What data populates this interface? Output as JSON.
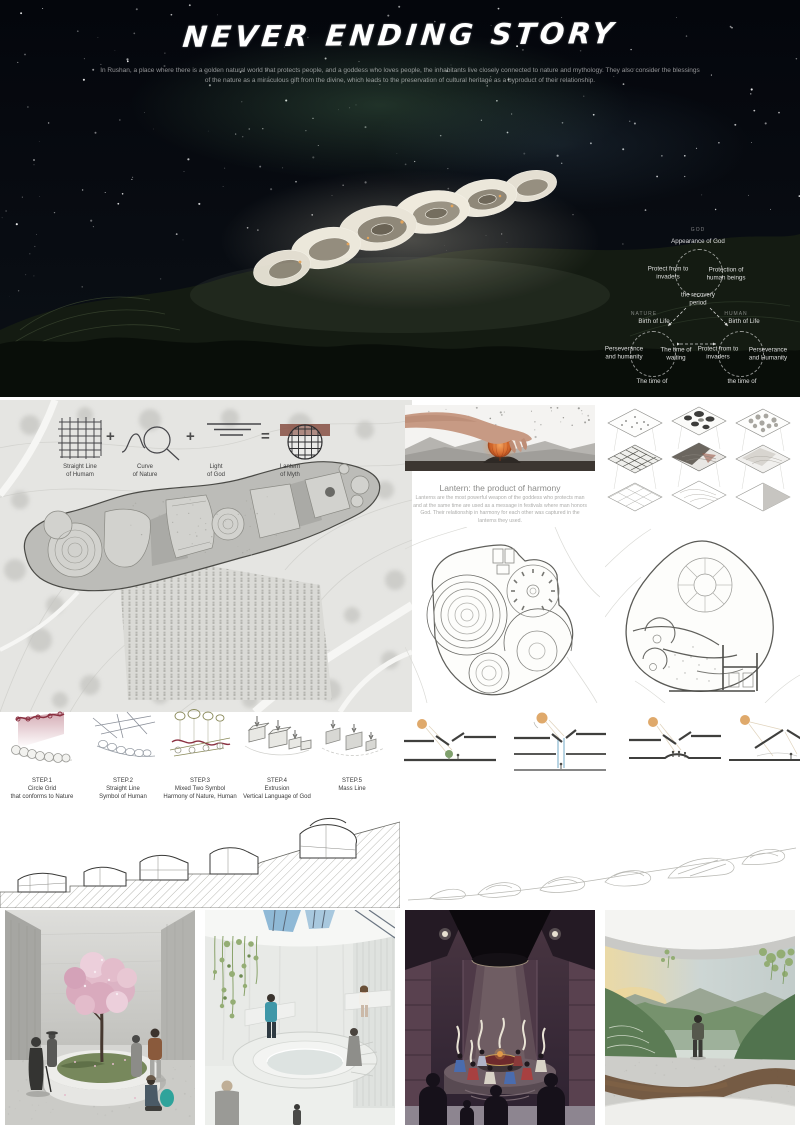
{
  "poster": {
    "title": "NEVER ENDING STORY",
    "intro_line1": "In Rushan, a place where there is a golden natural world that protects people, and a goddess who loves people, the inhabitants live closely connected to nature and mythology. They also consider the blessings",
    "intro_line2": "of the nature as a miraculous gift from the divine, which leads to the preservation of cultural heritage as a byproduct of their relationship."
  },
  "hero_diagram": {
    "god": {
      "tag": "GOD",
      "top": "Appearance of God",
      "left": "Protect from to invaders",
      "right": "Protection of human beings",
      "center": "the recovery period"
    },
    "nature": {
      "tag": "NATURE",
      "top": "Birth of Life",
      "left": "Perseverance and humanity",
      "right": "The time of waiting",
      "bottom": "The time of"
    },
    "human": {
      "tag": "HUMAN",
      "top": "Birth of Life",
      "left": "Protect from to invaders",
      "right": "Perseverance and Humanity",
      "bottom": "the time of"
    }
  },
  "concept": {
    "items": [
      {
        "line1": "Straight Line",
        "line2": "of Humam"
      },
      {
        "line1": "Curve",
        "line2": "of Nature"
      },
      {
        "line1": "Light",
        "line2": "of God"
      },
      {
        "line1": "Lantern",
        "line2": "of Myth"
      }
    ],
    "op1": "+",
    "op2": "+",
    "op3": "="
  },
  "lantern": {
    "heading": "Lantern: the product of harmony",
    "body": "Lanterns are the most powerful weapon of the goddess who protects man and at the same time are used as a message in festivals where man honors God. Their relationship in harmony for each other was captured in the lanterns they used."
  },
  "steps": [
    {
      "label": "STEP.1",
      "line1": "Circle Grid",
      "line2": "that conforms to Nature"
    },
    {
      "label": "STEP.2",
      "line1": "Straight Line",
      "line2": "Symbol of Human"
    },
    {
      "label": "STEP.3",
      "line1": "Mixed Two Symbol",
      "line2": "Harmony of Nature, Human"
    },
    {
      "label": "STEP.4",
      "line1": "Extrusion",
      "line2": "Vertical Language of God"
    },
    {
      "label": "STEP.5",
      "line1": "Mass Line",
      "line2": ""
    }
  ],
  "colors": {
    "lantern_orange": "#d96c2e",
    "blossom_pink": "#dcb3c4",
    "teal_accent": "#2fa39b",
    "theater_maroon": "#45323e",
    "sun_orange": "#dfa96b",
    "lightwell_blue": "#7fb0cc",
    "nature_green": "#7a9a6a",
    "step_red": "#8a3040"
  }
}
